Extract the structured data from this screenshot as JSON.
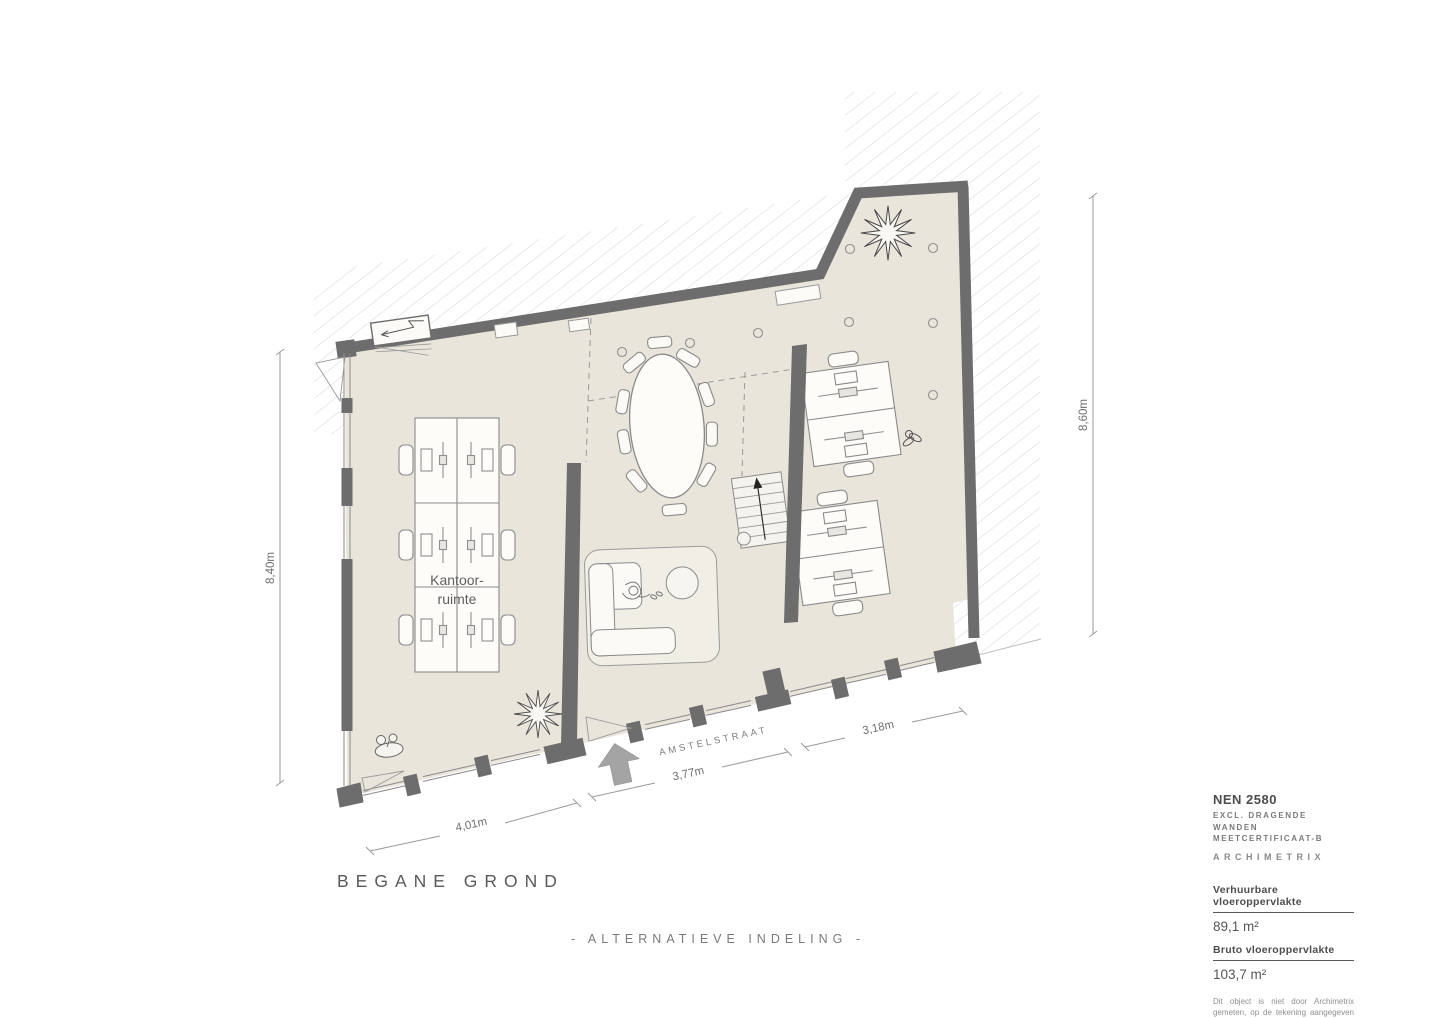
{
  "plan": {
    "title": "BEGANE GROND",
    "subtitle": "- ALTERNATIEVE INDELING -",
    "room_label": {
      "line1": "Kantoor-",
      "line2": "ruimte"
    },
    "street_name": "AMSTELSTRAAT",
    "dimensions": {
      "left_height": "8,40m",
      "right_height": "8,60m",
      "bottom_left_width": "4,01m",
      "bottom_middle_width": "3,77m",
      "bottom_right_width": "3,18m"
    }
  },
  "legend": {
    "standard": "NEN 2580",
    "note_line1": "EXCL. DRAGENDE WANDEN",
    "note_line2": "MEETCERTIFICAAT-B",
    "brand": "ARCHIMETRIX",
    "rentable_label": "Verhuurbare vloeroppervlakte",
    "rentable_value": "89,1 m²",
    "gross_label": "Bruto vloeroppervlakte",
    "gross_value": "103,7 m²",
    "disclaimer": "Dit object is niet door Archimetrix gemeten, op de tekening aangegeven maten zijn circa-maten."
  },
  "colors": {
    "floor": "#e9e5db",
    "rug": "#f1eee6",
    "wall": "#6d6d6d",
    "hatch": "#d8d8d8",
    "entrance_arrow": "#a4a4a4",
    "text": "#5a5a5a"
  }
}
